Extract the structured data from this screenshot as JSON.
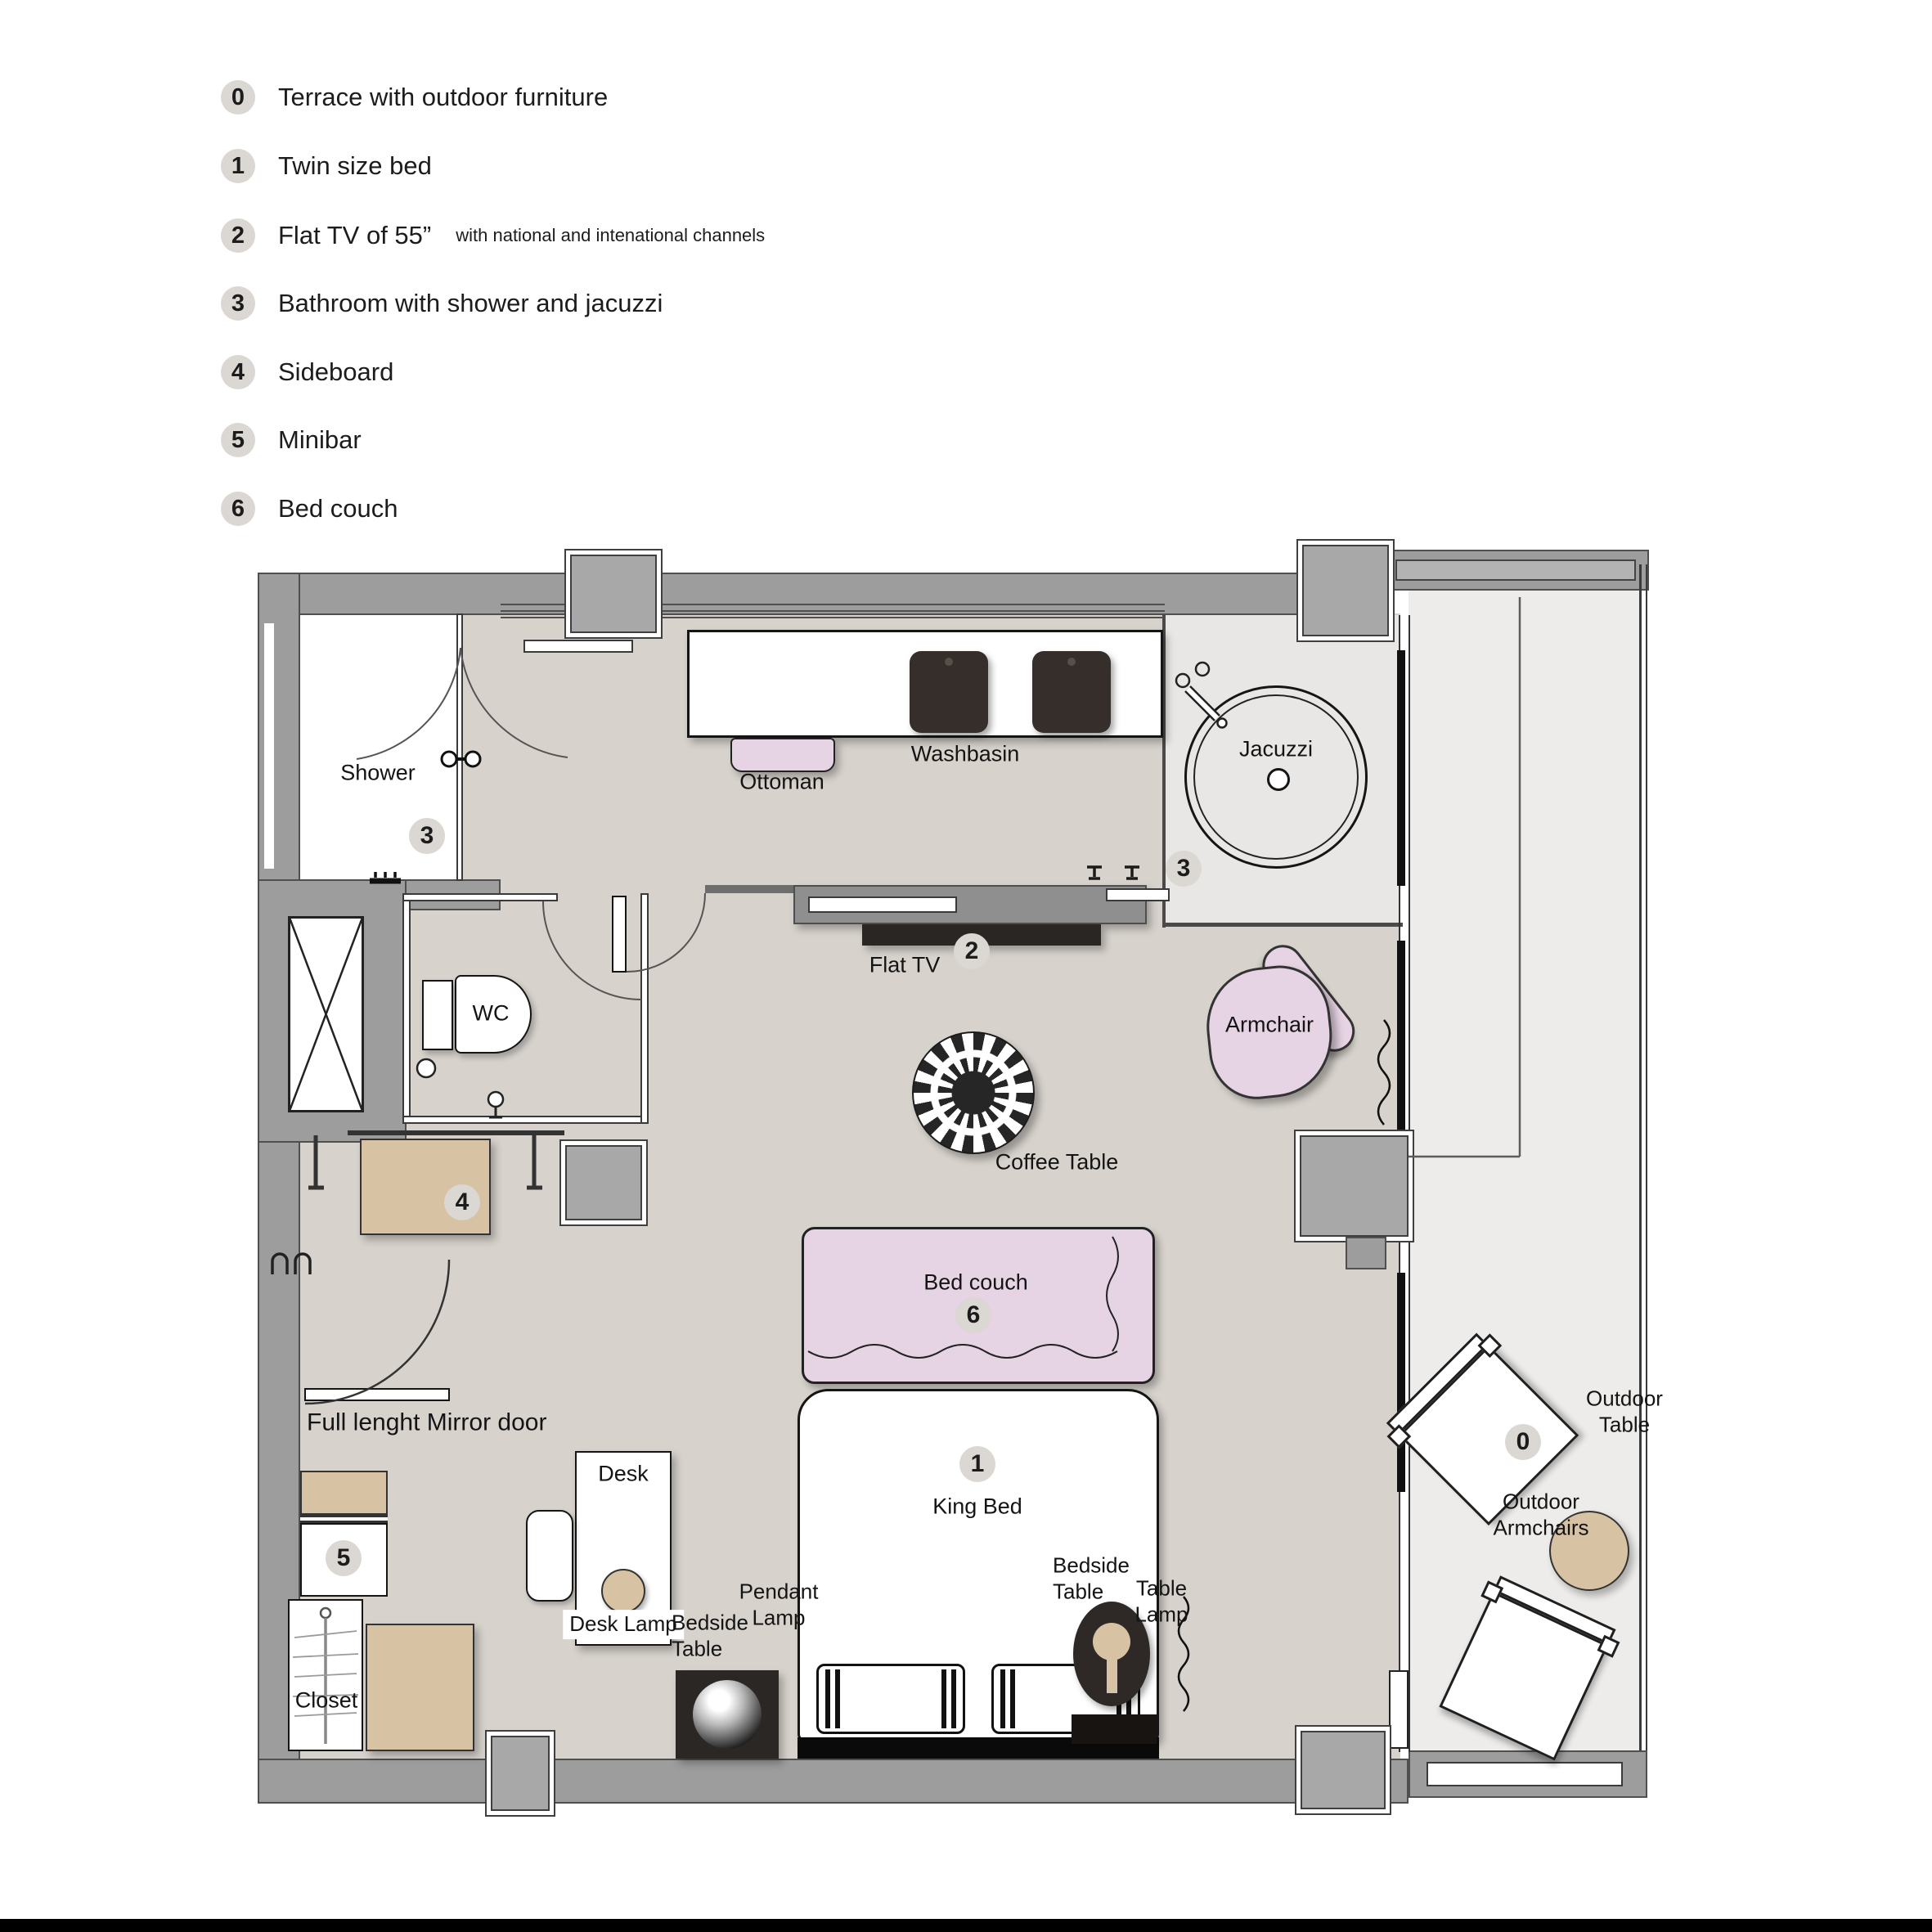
{
  "colors": {
    "wall": "#9d9d9d",
    "wall_line": "#4f4f4f",
    "floor": "#d7d2cc",
    "bath_floor": "#e9e7e5",
    "terrace_floor": "#edecea",
    "accent_pink": "#e6d3e3",
    "accent_tan": "#d8c2a4",
    "dark": "#2e2927",
    "badge_bg": "#dbd7d2",
    "ink": "#1c1c1c",
    "page_bg": "#ffffff"
  },
  "legend": {
    "items": [
      {
        "num": "0",
        "text": "Terrace with outdoor furniture",
        "suffix": ""
      },
      {
        "num": "1",
        "text": "Twin size bed",
        "suffix": ""
      },
      {
        "num": "2",
        "text": "Flat TV of 55”",
        "suffix": "with national and intenational channels"
      },
      {
        "num": "3",
        "text": "Bathroom with shower and jacuzzi",
        "suffix": ""
      },
      {
        "num": "4",
        "text": "Sideboard",
        "suffix": ""
      },
      {
        "num": "5",
        "text": "Minibar",
        "suffix": ""
      },
      {
        "num": "6",
        "text": "Bed couch",
        "suffix": ""
      }
    ]
  },
  "plan": {
    "labels": {
      "shower": "Shower",
      "wc": "WC",
      "washbasin": "Washbasin",
      "ottoman": "Ottoman",
      "jacuzzi": "Jacuzzi",
      "flat_tv": "Flat TV",
      "armchair": "Armchair",
      "coffee_table": "Coffee Table",
      "bed_couch": "Bed couch",
      "king_bed": "King Bed",
      "mirror_door": "Full lenght Mirror door",
      "desk": "Desk",
      "desk_lamp": "Desk Lamp",
      "bedside_left": "Bedside\nTable",
      "pendant_lamp": "Pendant\nLamp",
      "closet": "Closet",
      "bedside_right": "Bedside\nTable",
      "table_lamp": "Table\nLamp",
      "outdoor_table": "Outdoor\nTable",
      "outdoor_armchairs": "Outdoor\nArmchairs"
    },
    "badges": {
      "terrace": "0",
      "king_bed": "1",
      "flat_tv": "2",
      "shower": "3",
      "bathroom": "3",
      "sideboard": "4",
      "minibar": "5",
      "bed_couch": "6"
    }
  }
}
